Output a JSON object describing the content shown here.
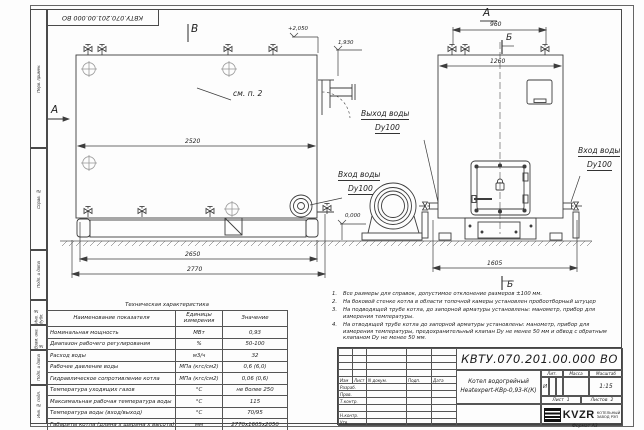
{
  "page": {
    "stamp_top": "КВТУ.070.201.00.000  ВО",
    "format_label": "Формат  А3"
  },
  "margin": {
    "cells": [
      "Перв. примен.",
      "Справ. №",
      "Подп. и дата",
      "Инв. № дубл.",
      "Взам. инв. №",
      "Подп. и дата",
      "Инв. № подл."
    ]
  },
  "views": {
    "side": {
      "view_label": "В",
      "section_label": "А",
      "see_note": "см. п. 2",
      "elev_top": "+2,050",
      "elev_outlet": "1,930",
      "elev_ground": "0,000",
      "dim_inner": "2520",
      "dim_bottom1": "2650",
      "dim_bottom2": "2770",
      "outlet_line1": "Выход воды",
      "outlet_line2": "Dy100",
      "inlet_line1": "Вход воды",
      "inlet_line2": "Dy100"
    },
    "front": {
      "view_label": "А",
      "section_label_top": "Б",
      "section_label_bottom": "Б",
      "dim_top": "960",
      "dim_inner": "1260",
      "dim_bottom": "1605",
      "inlet_line1": "Вход воды",
      "inlet_line2": "Dy100"
    }
  },
  "spec_table": {
    "title": "Техническая характеристика",
    "headers": [
      "Наименование показателя",
      "Единицы измерения",
      "Значение"
    ],
    "rows": [
      [
        "Номинальная мощность",
        "МВт",
        "0,93"
      ],
      [
        "Диапазон рабочего регулирования",
        "%",
        "50-100"
      ],
      [
        "Расход воды",
        "м3/ч",
        "32"
      ],
      [
        "Рабочее давление воды",
        "МПа (кгс/см2)",
        "0,6 (6,0)"
      ],
      [
        "Гидравлическое сопротивление котла",
        "МПа (кгс/см2)",
        "0,06 (0,6)"
      ],
      [
        "Температура уходящих газов",
        "°С",
        "не более 250"
      ],
      [
        "Максимальная рабочая температура воды",
        "°С",
        "115"
      ],
      [
        "Температура воды (вход/выход)",
        "°С",
        "70/95"
      ],
      [
        "Габариты котла (длина х ширина х высота)",
        "мм",
        "2770х1605х2050"
      ]
    ]
  },
  "notes": [
    {
      "n": "1.",
      "t": "Все размеры для справок, допустимое отклонение размеров ±100 мм."
    },
    {
      "n": "2.",
      "t": "На боковой стенке котла в области топочной камеры установлен пробоотборный штуцер"
    },
    {
      "n": "3.",
      "t": "На подводящей трубе котла, до запорной арматуры установлены: манометр, прибор для измерения температуры."
    },
    {
      "n": "4.",
      "t": "На отводящей трубе котла до запорной арматуры установлены: манометр, прибор для измерения температуры, предохранительный клапан Dу не менее 50 мм и обвод с обратным клапаном Dу не менее 50 мм."
    }
  ],
  "title_block": {
    "doc_number": "КВТУ.070.201.00.000  ВО",
    "name_line1": "Котел водогрейный",
    "name_line2": "Heatexpert-КВр-0,93-К(К)",
    "rev_headers": [
      "Изм",
      "Лист",
      "N докум.",
      "Подп.",
      "Дата"
    ],
    "roles": [
      "Разраб.",
      "Пров.",
      "Т.контр.",
      "",
      "Н.контр.",
      "Утв."
    ],
    "lit_header": "Лит.",
    "mass_header": "Масса",
    "scale_header": "Масштаб",
    "lit_value": "И",
    "scale_value": "1:15",
    "sheet_label": "Лист",
    "sheet_value": "1",
    "sheets_label": "Листов",
    "sheets_value": "2",
    "logo_text": "KVZR",
    "company_line1": "КОТЕЛЬНЫЙ",
    "company_line2": "ЗАВОД РЭП"
  }
}
